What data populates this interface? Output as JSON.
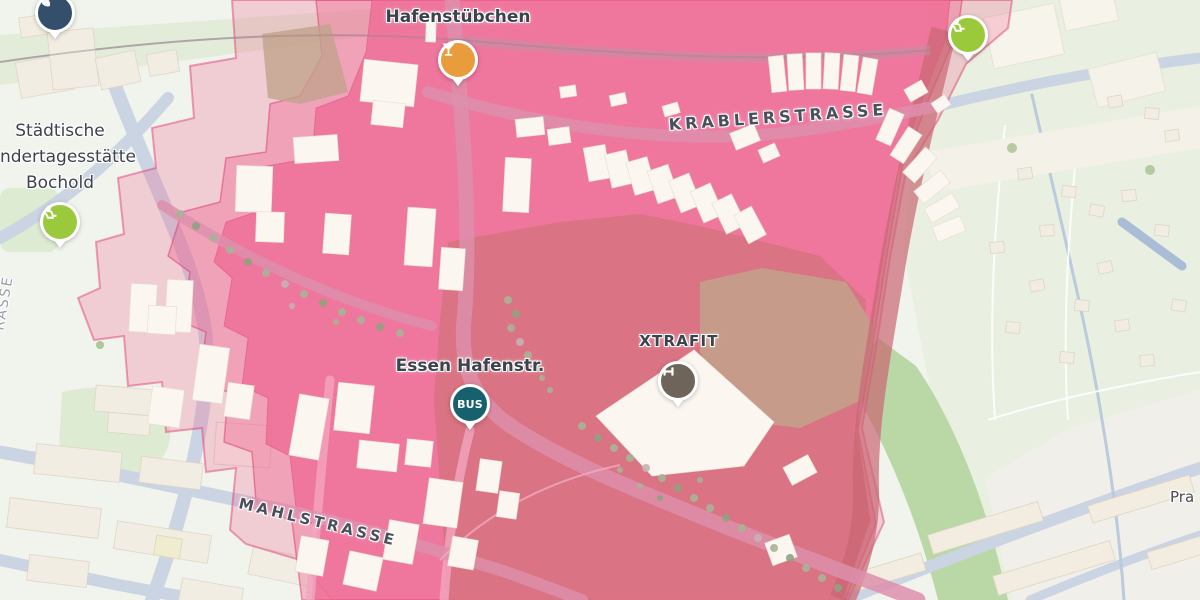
{
  "theme": {
    "bg": "#F1F3ED",
    "garden-green": "#E9F0E1",
    "rail-band": "#E2ECD8",
    "park-band": "#BAD8A6",
    "park": "#DDEBD2",
    "road": "#CBD4E2",
    "water": "#B9CBDC",
    "road-pink": "#DD8FAC",
    "bld-beige": "#F2EDE2",
    "bld-row": "#F2EDE0",
    "bld-white": "#FBF7F0",
    "ov-pink": "#EE5E8C",
    "ov-core": "#EE6F96",
    "ov-dark": "#D6737F",
    "ov-tan": "#C2A28C",
    "ov-maroon": "#C96672",
    "ov-edge": "#E0336E",
    "tree": "#A9B296",
    "label": "#3D434C",
    "marker-bar": "#E89C3B",
    "marker-playground": "#9ACA3C",
    "marker-gym": "#6E6459",
    "marker-bus": "#17606E",
    "marker-navy": "#344F6B"
  },
  "labels": {
    "hafenstuebchen": "Hafenstübchen",
    "kita_line1": "Städtische",
    "kita_line2": "Kindertagesstätte",
    "kita_line3": "Bochold",
    "krablerstrasse": "KRABLERSTRASSE",
    "xtrafit": "XTRAFIT",
    "bus_stop": "Essen Hafenstr.",
    "mahlstrasse": "MAHLSTRASSE",
    "street_right_partial": "Pra",
    "street_left_partial": "RASSE"
  },
  "markers": {
    "bar": {
      "poi": "Hafenstübchen",
      "icon": "cocktail-icon",
      "color": "#E89C3B"
    },
    "playground_right": {
      "poi": "playground",
      "icon": "playground-person-icon",
      "color": "#9ACA3C"
    },
    "playground_left": {
      "poi": "playground",
      "icon": "playground-person-icon",
      "color": "#9ACA3C"
    },
    "gym": {
      "poi": "XTRAFIT",
      "icon": "dumbbell-icon",
      "color": "#6E6459"
    },
    "bus": {
      "label": "BUS",
      "poi": "Essen Hafenstr.",
      "icon": "bus-badge",
      "color": "#17606E"
    },
    "navy": {
      "poi": "unknown (cut off)",
      "icon": "leaf-icon",
      "color": "#344F6B"
    }
  }
}
